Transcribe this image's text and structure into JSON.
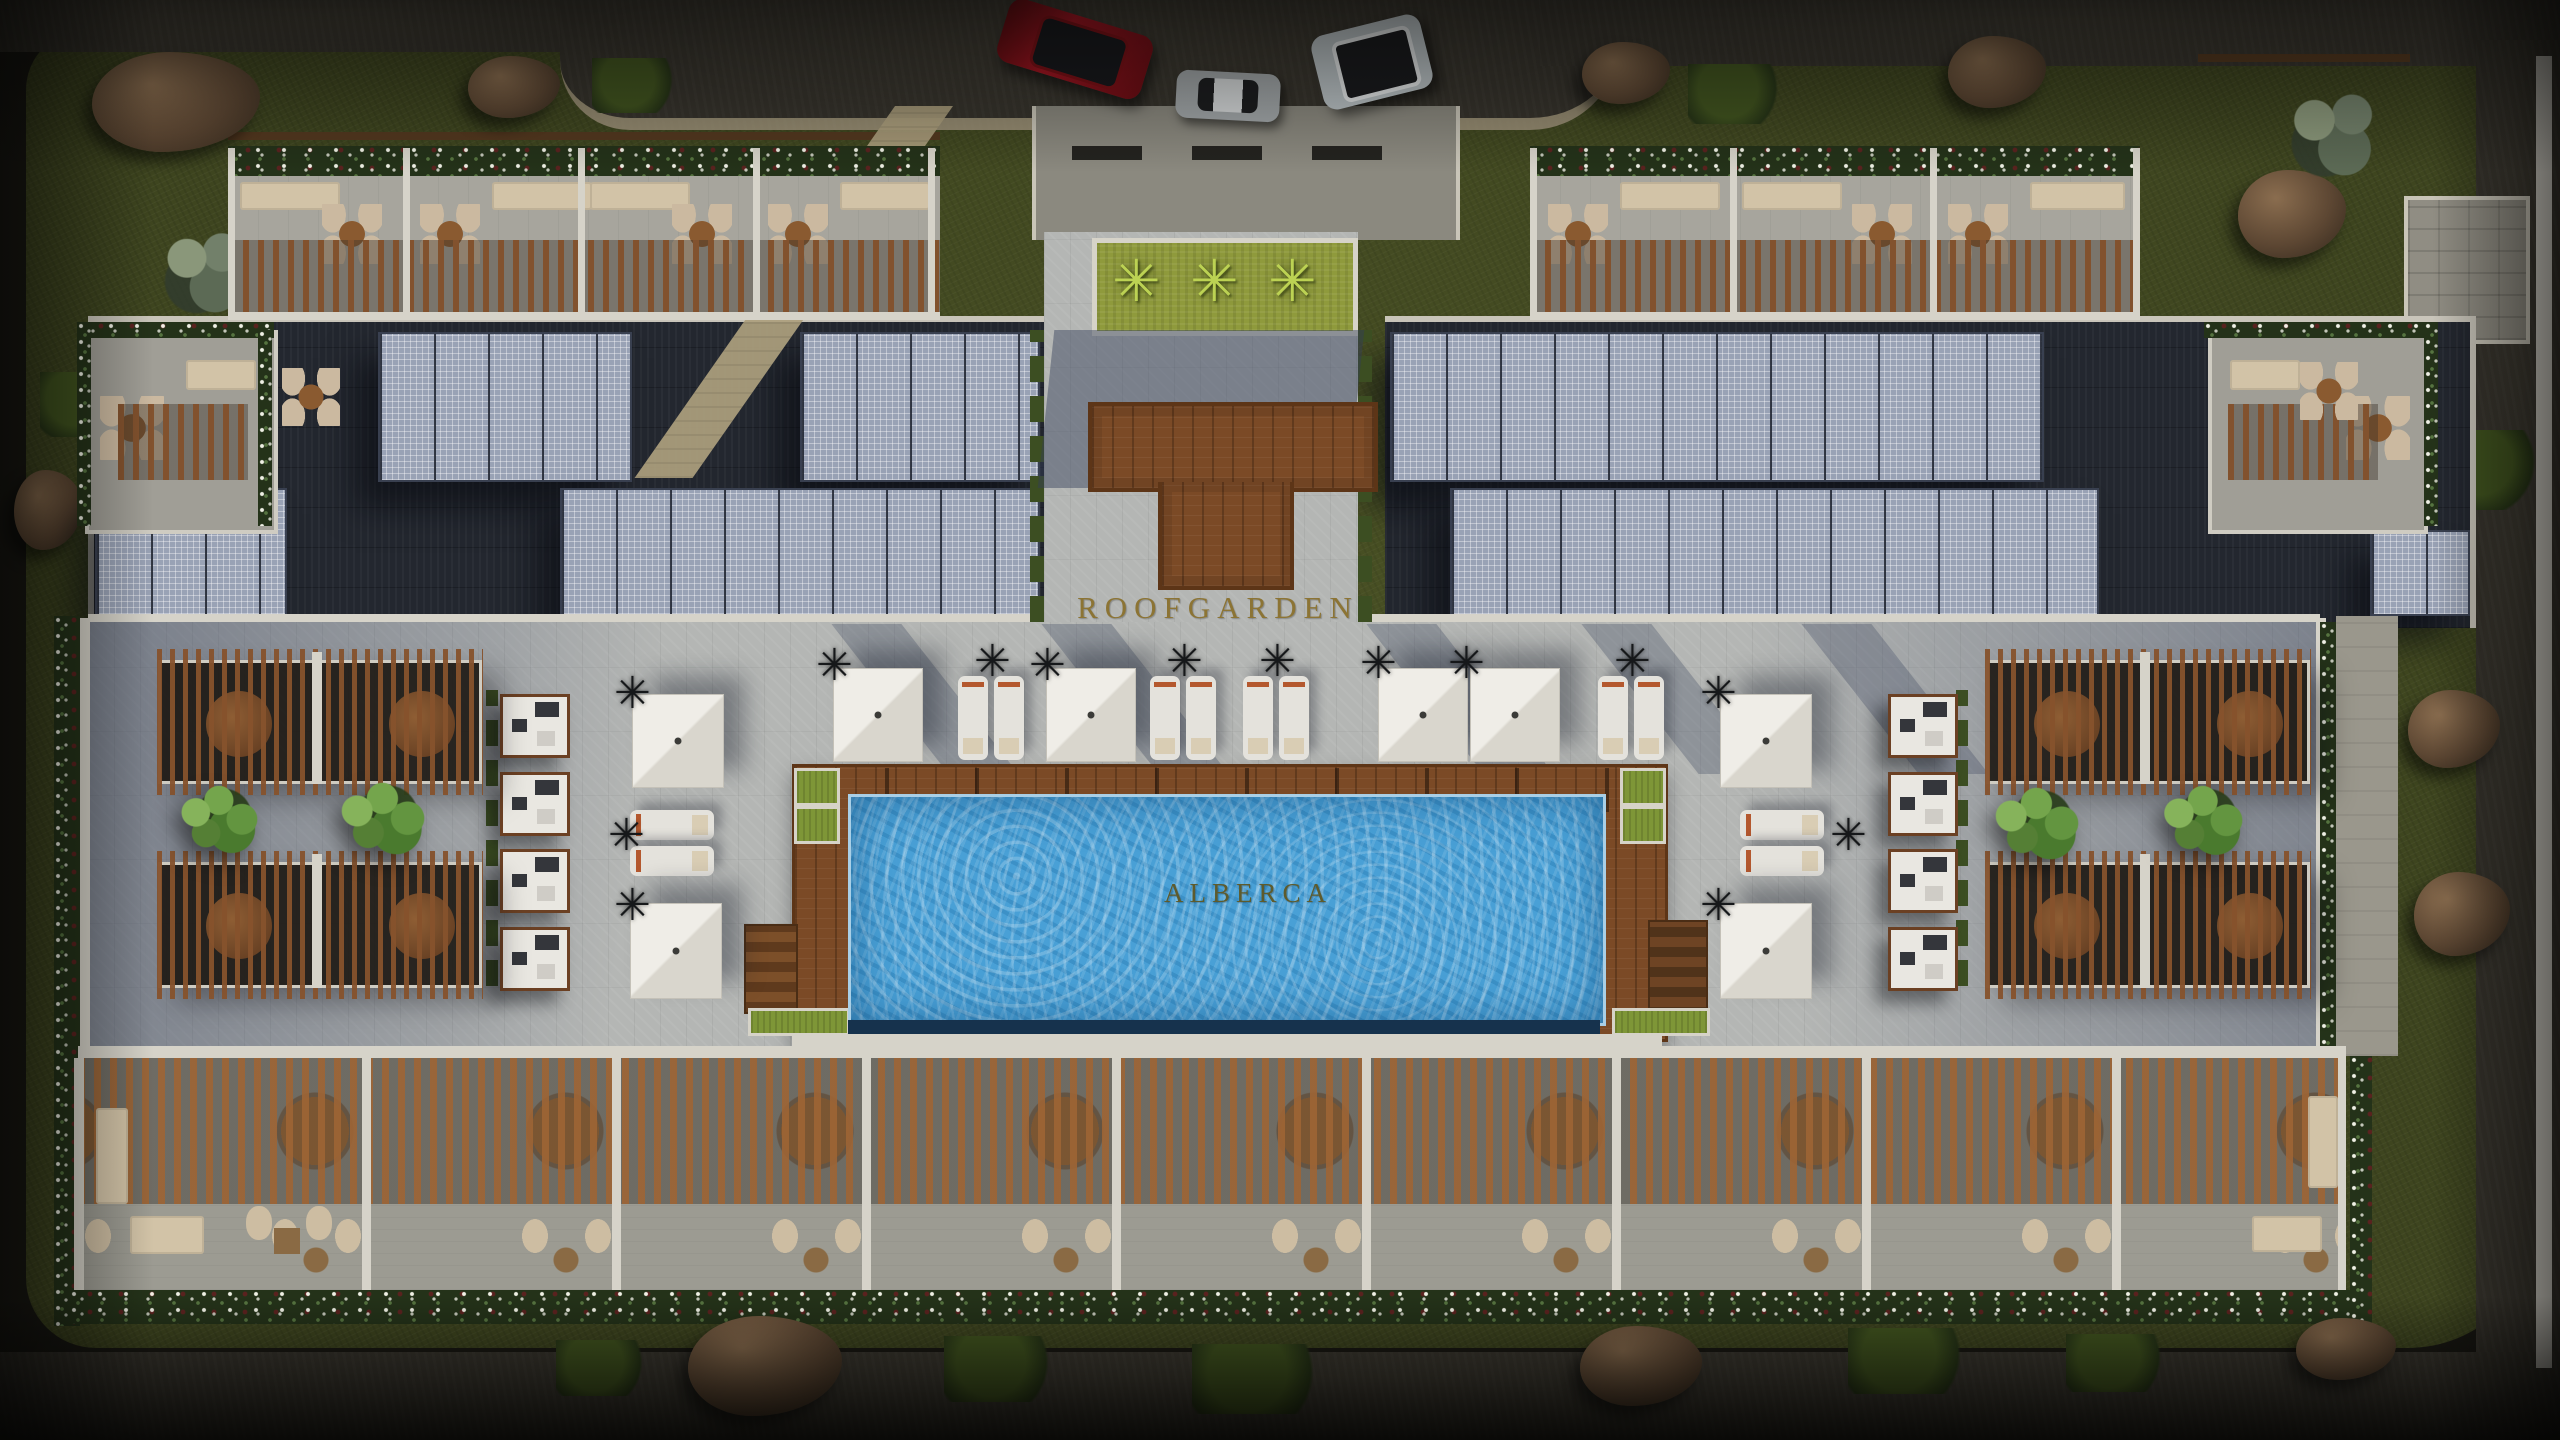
{
  "scene": {
    "description": "Aerial architectural render of a rooftop amenity deck with pool, solar panels, pergolas and terraces",
    "area_labels": {
      "roof_garden": "ROOFGARDEN",
      "pool": "ALBERCA"
    },
    "icons": {
      "palm_glyph": "✳"
    },
    "palette": {
      "label_gold": "#8c7434",
      "pool_label_olive": "#5d5b2d",
      "pool_water": "#49a0d6",
      "wood_deck": "#7b4a26",
      "stone_paving": "#b4b6b4",
      "solar_panel": "#99a2b5",
      "pergola_wood": "#8a5531",
      "grass": "#3e451f",
      "asphalt_road": "#36332c",
      "white_wall": "#d6d3c9",
      "hedge_green": "#243219"
    },
    "vehicles": [
      {
        "name": "red-suv",
        "body_color": "#a81522"
      },
      {
        "name": "grey-sports-car",
        "body_color": "#a3a8aa"
      },
      {
        "name": "silver-suv",
        "body_color": "#bcc4c7"
      }
    ]
  }
}
